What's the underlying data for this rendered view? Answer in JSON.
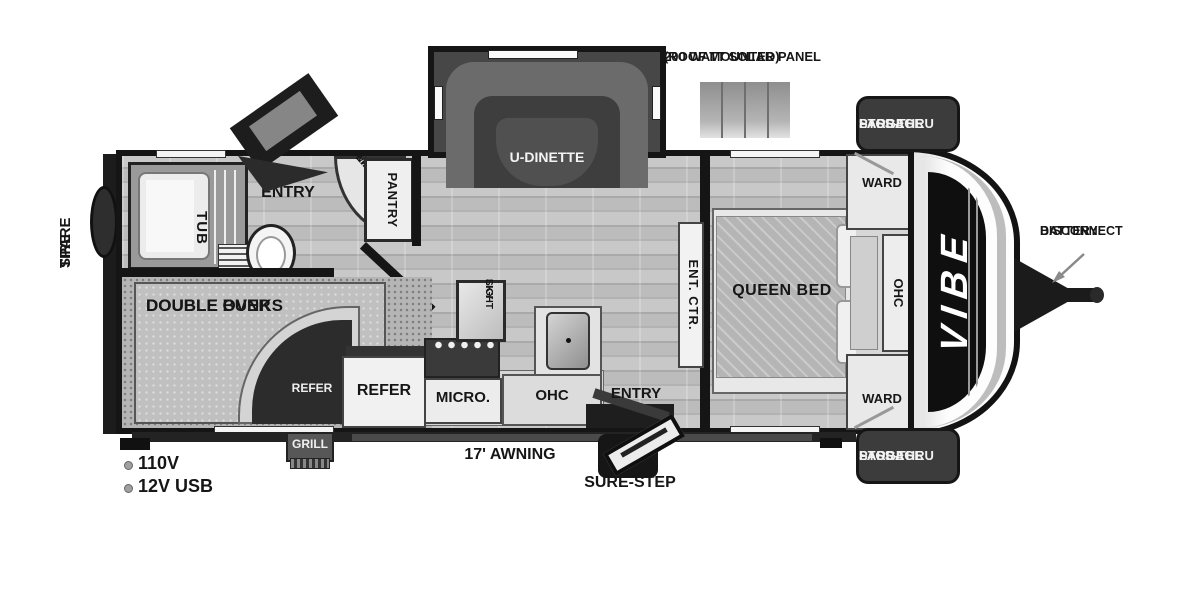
{
  "annotations": {
    "solar_panel_line1": "200 WATT SOLAR PANEL",
    "solar_panel_line2": "(ROOF MOUNTED)",
    "battery_line1": "BATTERY",
    "battery_line2": "DISCONNECT",
    "spare_tire_line1": "SPARE",
    "spare_tire_line2": "TIRE",
    "awning": "17' AWNING",
    "sure_step": "SURE-STEP",
    "grill": "GRILL",
    "power_110v": "110V",
    "power_12v_usb": "12V USB",
    "storage_top_line1": "LARGE",
    "storage_top_line2": "PASS-THRU",
    "storage_top_line3": "STORAGE",
    "storage_bottom_line1": "LARGE",
    "storage_bottom_line2": "PASS-THRU",
    "storage_bottom_line3": "STORAGE"
  },
  "rooms": {
    "u_dinette": "U-DINETTE",
    "tub": "TUB",
    "rear_entry": "ENTRY",
    "med_lav_line1": "MED.",
    "med_lav_line2": "LAV",
    "pantry": "PANTRY",
    "bunks_line1": "DOUBLE OVER",
    "bunks_line2": "DOUBLE BUNKS",
    "refer_small": "REFER",
    "refer_large": "REFER",
    "micro": "MICRO.",
    "kitchen_ohc": "OHC",
    "sky_light_line1": "SKY",
    "sky_light_line2": "LIGHT",
    "main_entry": "ENTRY",
    "ent_ctr": "ENT. CTR.",
    "queen_bed": "QUEEN BED",
    "ward_top": "WARD",
    "ward_bottom": "WARD",
    "bedroom_ohc": "OHC",
    "brand": "VIBE"
  },
  "colors": {
    "wall": "#151515",
    "badge_bg": "#3c3c3c",
    "dark_furniture": "#3e3e3e",
    "light_furniture": "#ececec"
  }
}
